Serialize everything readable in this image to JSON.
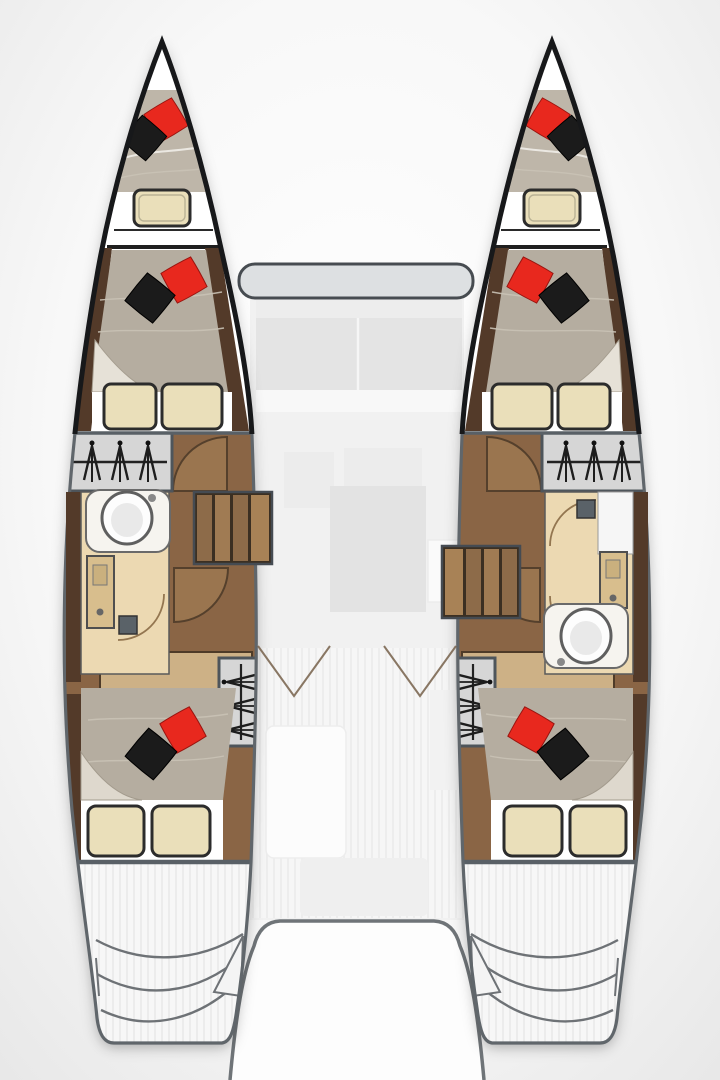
{
  "palette": {
    "background_center": "#ffffff",
    "background_edge": "#e7e7e7",
    "hull_white": "#ffffff",
    "outline_black": "#17181a",
    "outline_gray": "#60666b",
    "divider_gray": "#596066",
    "duvet": "#b5ada0",
    "duvet_light": "#beb6a9",
    "pillow_red": "#e8281e",
    "pillow_black": "#1b1b1b",
    "pillow_cream": "#eadfba",
    "sheet_white": "#ffffff",
    "wood_floor": "#8a6545",
    "wood_light": "#9a754f",
    "wood_dark": "#533a29",
    "bath_floor": "#ecd9b2",
    "vanity_tan": "#d8be8d",
    "locker_gray": "#d6d6d6",
    "counter_white": "#f6f4ef",
    "basin_white": "#fdfdfd",
    "drain_gray": "#5a6268",
    "ghost_light": "#f1f1f1",
    "ghost_mid": "#e4e4e4",
    "coachroof_gray": "#dde0e2",
    "teak_line": "#e9e9e9",
    "step_line": "#6e7276",
    "stair_tread_a": "#8d6b49",
    "stair_tread_b": "#a07b53"
  },
  "diagram": {
    "type": "floor_plan",
    "subject": "catamaran interior layout, top-down view",
    "text_labels": [],
    "port_hull": {
      "rooms": [
        "bow-berth",
        "forward-cabin",
        "hanging-locker",
        "bathroom",
        "corridor-with-stairs",
        "aft-cabin",
        "transom-steps"
      ],
      "bathroom_features": [
        "sink-basin-top",
        "vanity-left",
        "shower-drain-bottom",
        "door-swing-arcs"
      ]
    },
    "starboard_hull": {
      "rooms": [
        "bow-berth",
        "forward-cabin",
        "hanging-locker",
        "bathroom",
        "corridor-with-stairs",
        "aft-cabin",
        "transom-steps"
      ],
      "bathroom_features": [
        "shower-drain-top",
        "vanity-right",
        "sink-basin-bottom",
        "door-swing-arcs"
      ]
    },
    "bridgedeck": {
      "areas": [
        "coachroof-front-band",
        "salon-sofa-faded",
        "galley-faded",
        "cockpit-teak-faded",
        "aft-cutout-between-transoms"
      ]
    },
    "legend_counts": {
      "double_berths": 6,
      "bathrooms": 2,
      "hanging_lockers": 4,
      "stair_flights": 2,
      "red_pillows": 6,
      "black_pillows": 6,
      "cream_pillows": 10
    },
    "icons": [
      "hanger-rail-icon",
      "sink-icon",
      "faucet-icon",
      "shower-drain-icon",
      "door-swing-arc-icon",
      "stairs-icon"
    ]
  }
}
